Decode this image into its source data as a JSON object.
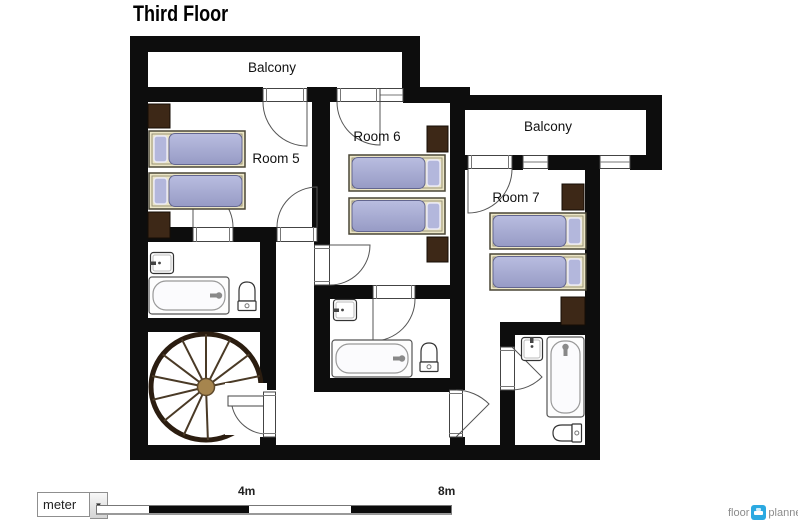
{
  "title": "Third Floor",
  "plan": {
    "balcony_left": "Balcony",
    "room5": "Room 5",
    "room6": "Room 6",
    "balcony_right": "Balcony",
    "room7": "Room 7"
  },
  "scale_bar": {
    "unit": "meter",
    "mid_label": "4m",
    "end_label": "8m"
  },
  "logo": {
    "part1": "floor",
    "part2": "planner"
  },
  "colors": {
    "wall": "#0d0d0d",
    "mattress": "#a0a4cd",
    "pillow": "#b3b7dc",
    "bed_frame": "#ece6c6",
    "wardrobe": "#3d2817",
    "stair_wood": "#8a6d42",
    "logo_blue": "#2ba9e1",
    "scale_black": "#0c0c0c"
  }
}
